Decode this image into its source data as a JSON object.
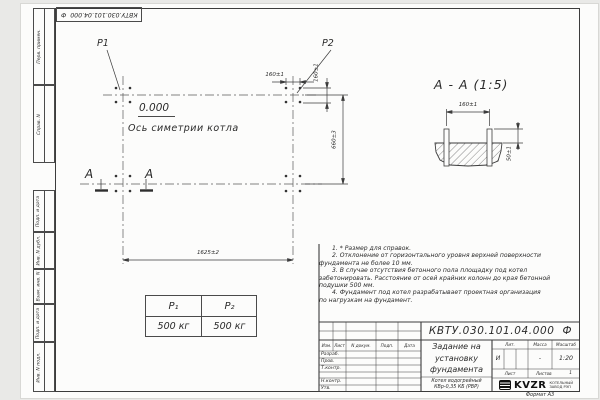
{
  "stamp": {
    "number": "КВТУ.030.101.04.000  Ф"
  },
  "margin_labels": [
    "Перв. примен.",
    "Справ. N",
    "Подп. и дата",
    "Инв. N дубл.",
    "Взам. инв. N",
    "Подп. и дата",
    "Инв. N подл."
  ],
  "plan": {
    "p1": "P1",
    "p2": "P2",
    "level": "0.000",
    "axis": "Ось симетрии котла",
    "dim_width_top": "160±1",
    "dim_height_top": "160±1",
    "dim_span_vertical": "660±3",
    "dim_span_horizontal": "1625±2",
    "section_letter_left": "А",
    "section_letter_right": "А"
  },
  "section_view": {
    "title": "А - А (1:5)",
    "dim_bolt_spacing": "160±1",
    "dim_protrusion": "50±1"
  },
  "notes": {
    "lines": [
      "1. * Размер для справок.",
      "2. Отклонение от горизонтального уровня верхней поверхности",
      "фундамента не более 10 мм.",
      "3. В случае отсутствия бетонного пола площадку под котел",
      "забетонировать. Расстояние от осей крайних колонн до края бетонной",
      "подушки 500 мм.",
      "4. Фундамент под котел разрабатывает проектная организация",
      "по нагрузкам на фундамент."
    ]
  },
  "load_table": {
    "col1_header": "Р₁",
    "col2_header": "Р₂",
    "col1_value": "500 кг",
    "col2_value": "500 кг"
  },
  "title_block": {
    "doc_number": "КВТУ.030.101.04.000  Ф",
    "rev_headers": [
      "Изм.",
      "Лист",
      "N докум.",
      "Подп.",
      "Дата"
    ],
    "sig_labels": [
      "Разраб.",
      "Пров.",
      "Т.контр.",
      "Н.контр.",
      "Утв."
    ],
    "title_lines": [
      "Задание на",
      "установку",
      "фундамента"
    ],
    "product_lines": [
      "Котел водогрейный",
      "КВр-0,35 КБ (РВР)"
    ],
    "lit_header": "Лит.",
    "mass_header": "Масса",
    "scale_header": "Масштаб",
    "lit_value": "И",
    "mass_value": "-",
    "scale_value": "1:20",
    "sheet_label": "Лист",
    "sheets_label": "Листов",
    "sheets_value": "1",
    "logo_text": "KVZR",
    "logo_caption_lines": [
      "КОТЕЛЬНЫЙ",
      "ЗАВОД РЭП"
    ],
    "format_label": "Формат А3"
  },
  "colors": {
    "line": "#3c3c3c",
    "paper": "#fcfcfb"
  }
}
